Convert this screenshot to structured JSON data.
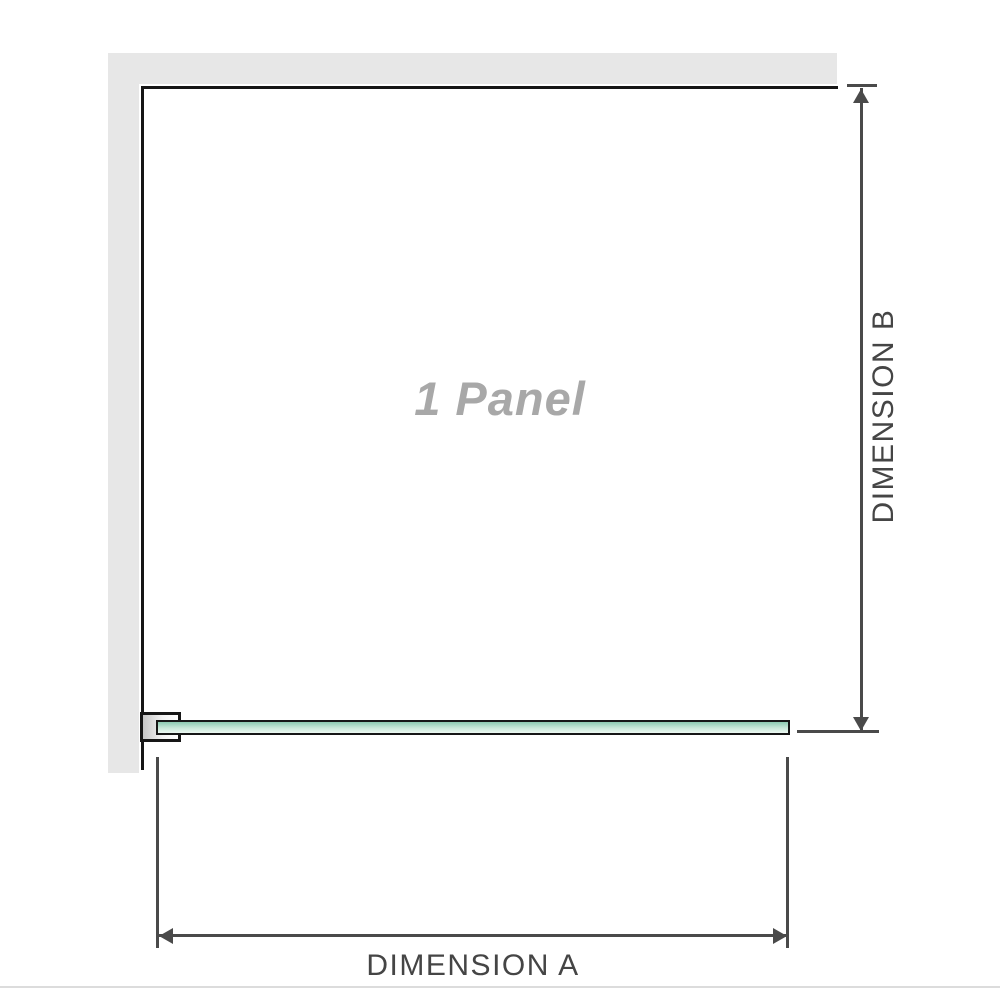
{
  "diagram": {
    "title": "shower panel dimension diagram",
    "panel_label": "1 Panel",
    "dimension_a_label": "DIMENSION A",
    "dimension_b_label": "DIMENSION B"
  },
  "colors": {
    "background": "#ffffff",
    "wall": "#e7e7e7",
    "outline": "#161616",
    "dimension_line": "#4a4a4a",
    "dimension_text": "#454545",
    "panel_text": "#a8a8a8",
    "glass_top": "#8cc9b1",
    "glass_mid": "#c9e8d9",
    "glass_bottom": "#ecf8f1",
    "bracket_fill_start": "#c6c6c6",
    "bracket_fill_end": "#ffffff",
    "baseline": "#dcdcdc"
  }
}
